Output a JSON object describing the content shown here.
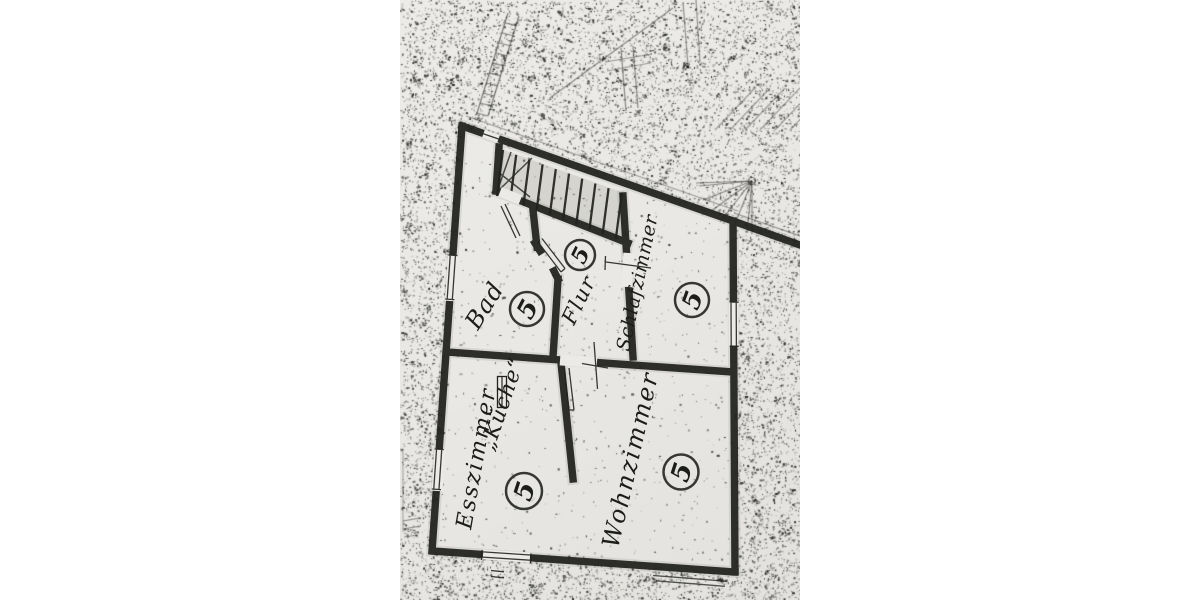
{
  "colors": {
    "page_background": "#ffffff",
    "paper": "#e9e8e4",
    "ink": "#22231f"
  },
  "floorplan": {
    "description_note": "",
    "rooms": [
      {
        "name": "bad",
        "label": "Bad",
        "number": "5"
      },
      {
        "name": "flur",
        "label": "Flur",
        "number": "5"
      },
      {
        "name": "schlafzimmer",
        "label": "Schlafzimmer",
        "number": "5"
      },
      {
        "name": "esszimmer",
        "label": "Esszimmer",
        "number": "5",
        "secondary_label": "„Küche“"
      },
      {
        "name": "wohnzimmer",
        "label": "Wohnzimmer",
        "number": "5"
      }
    ]
  }
}
